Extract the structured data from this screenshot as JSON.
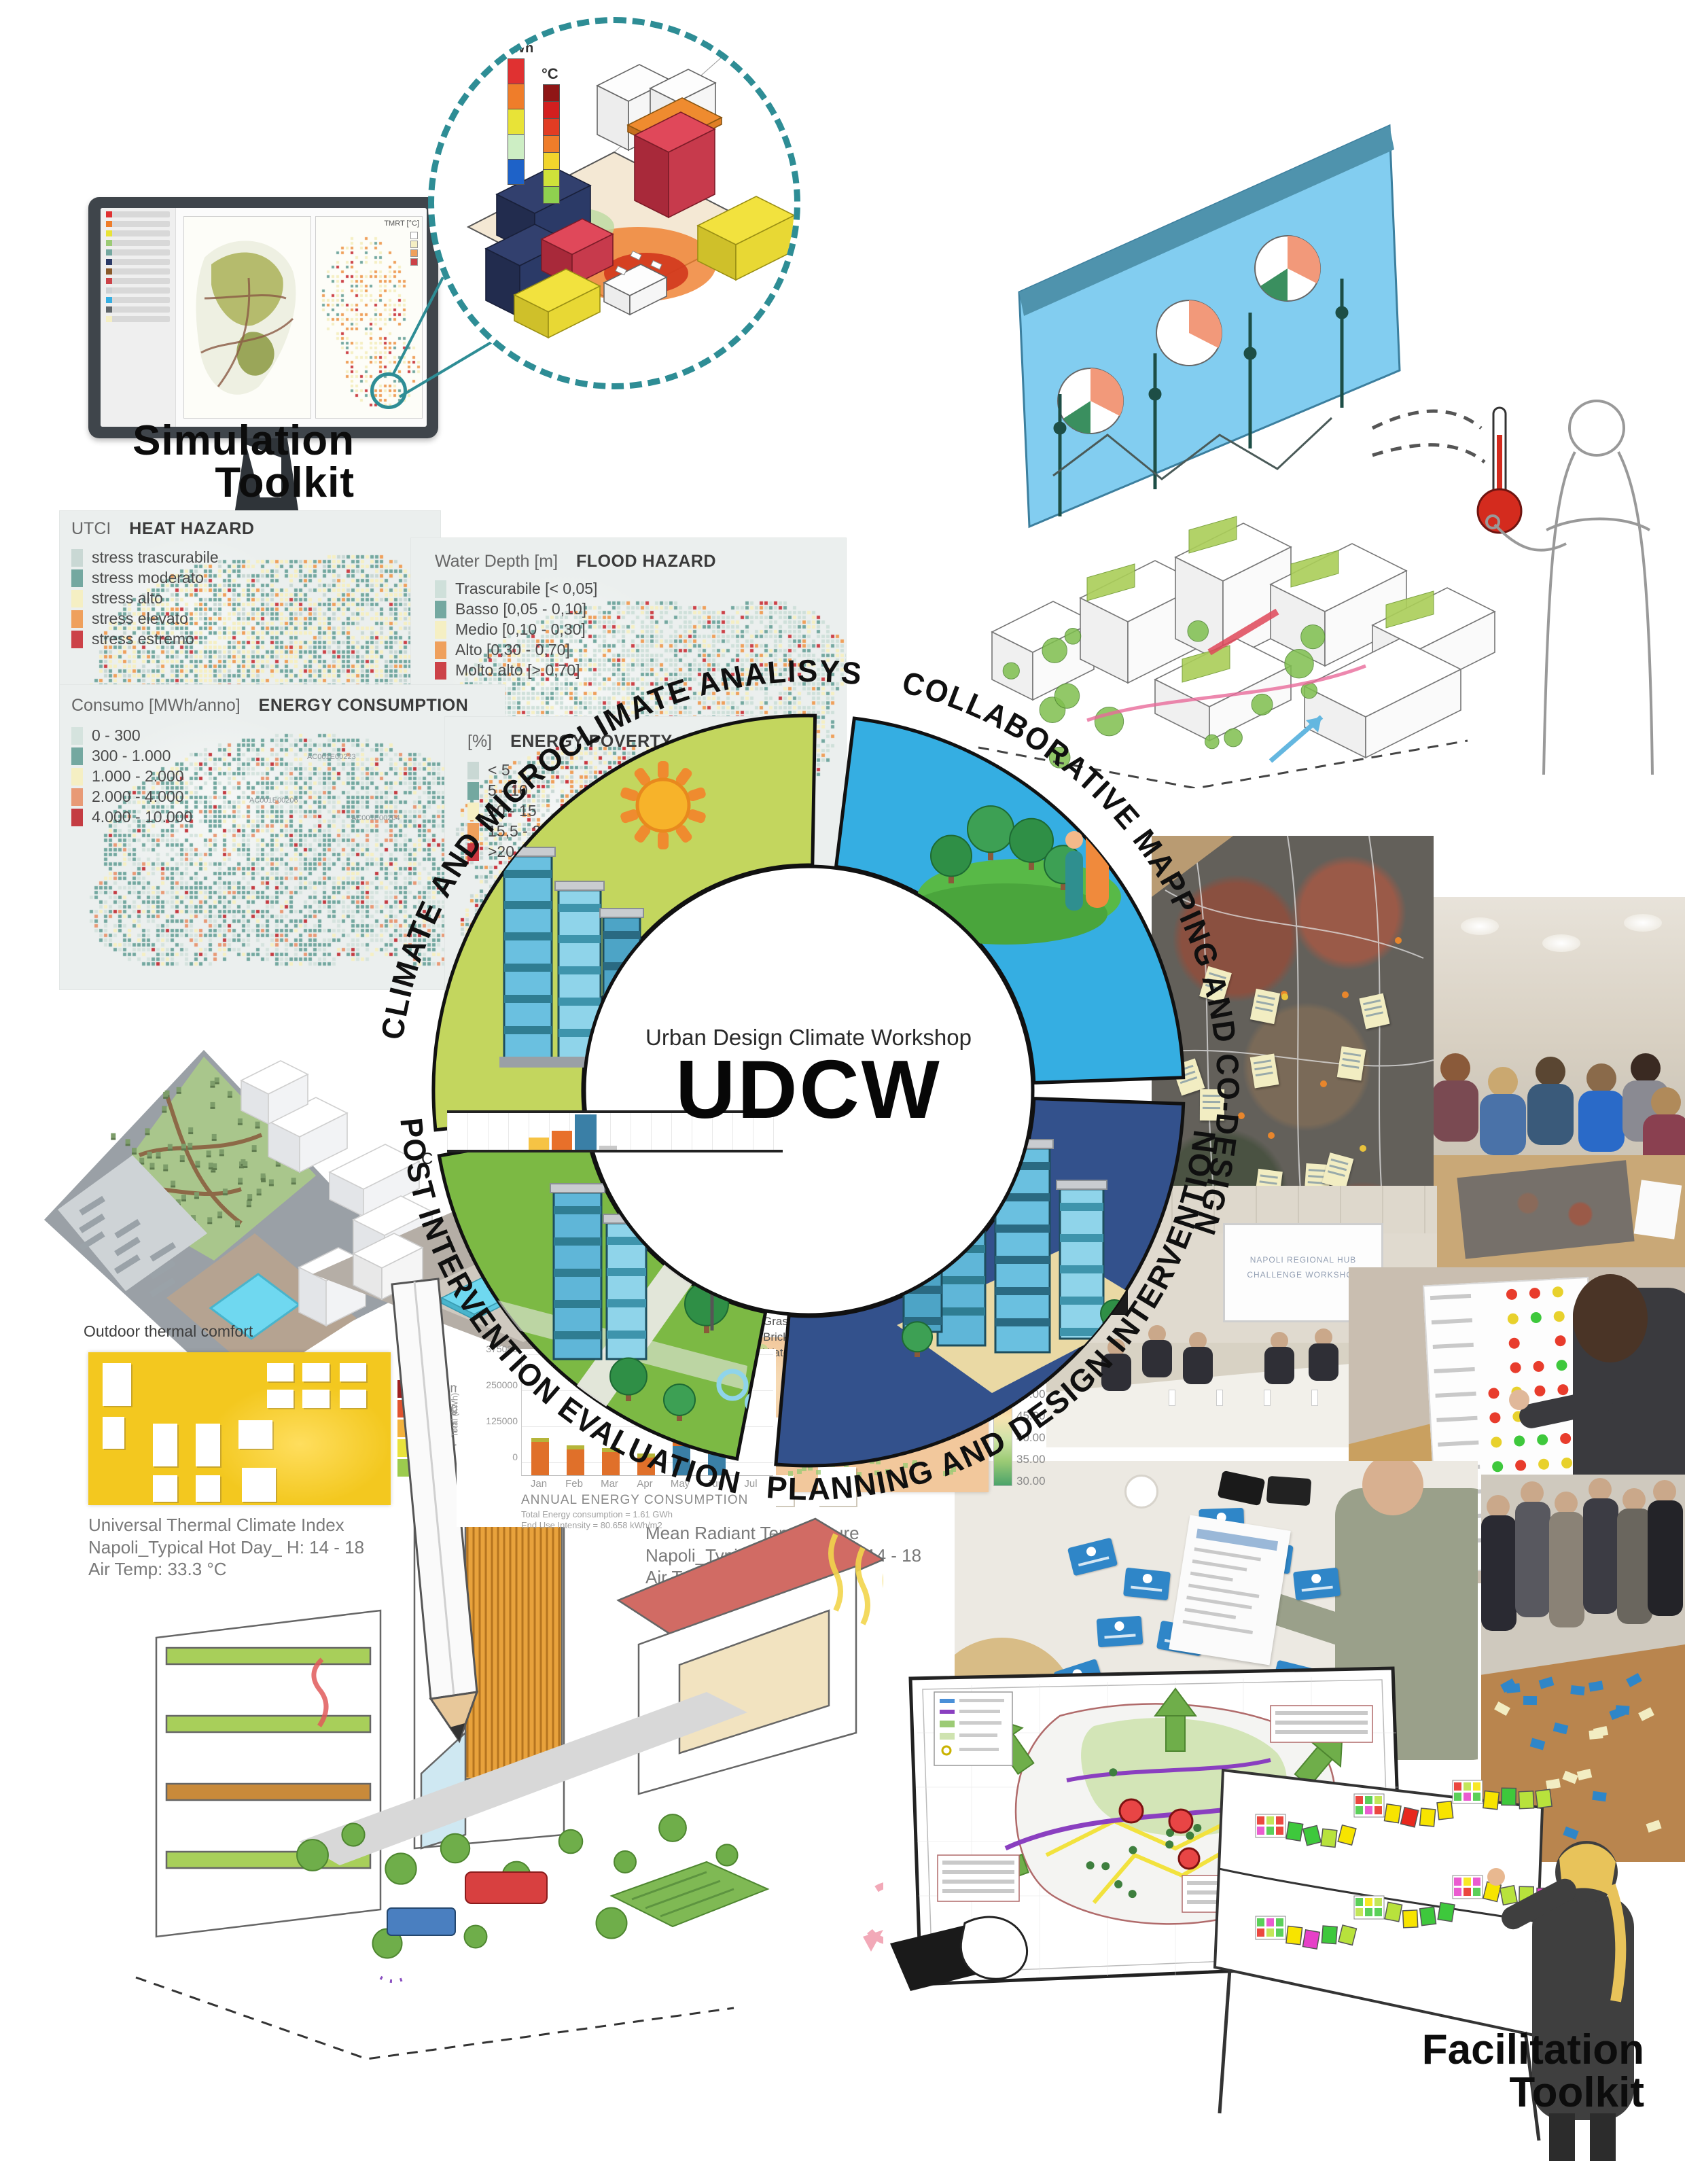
{
  "simulation_toolkit": {
    "label_line1": "Simulation",
    "label_line2": "Toolkit"
  },
  "facilitation_toolkit": {
    "label_line1": "Facilitation",
    "label_line2": "Toolkit"
  },
  "monitor": {
    "map_legend_title": "TMRT [°C]"
  },
  "zoom_detail": {
    "kwh_label": "kWh",
    "celsius_label": "°C",
    "kwh_scale_colors": [
      "#e03131",
      "#ef7d2a",
      "#e8e337",
      "#cdeec4",
      "#1e62c8"
    ],
    "celsius_scale_colors": [
      "#8f1616",
      "#d31f1f",
      "#e23c23",
      "#ef7d2a",
      "#f2d52c",
      "#cfe23a",
      "#8fd14f"
    ],
    "dashed_circle_color": "#2e8d95"
  },
  "maps": {
    "heat_hazard": {
      "prefix": "UTCI",
      "title": "HEAT HAZARD",
      "legend": [
        {
          "label": "stress trascurabile",
          "color": "#c9d8d4"
        },
        {
          "label": "stress moderato",
          "color": "#74a8a0"
        },
        {
          "label": "stress alto",
          "color": "#f5efc3"
        },
        {
          "label": "stress elevato",
          "color": "#efa05c"
        },
        {
          "label": "stress estremo",
          "color": "#cc4248"
        }
      ]
    },
    "flood_hazard": {
      "prefix": "Water Depth [m]",
      "title": "FLOOD HAZARD",
      "legend": [
        {
          "label": "Trascurabile [< 0,05]",
          "color": "#cfe0da"
        },
        {
          "label": "Basso [0,05 - 0,10]",
          "color": "#74a8a0"
        },
        {
          "label": "Medio [0,10 - 0,30]",
          "color": "#f5efc3"
        },
        {
          "label": "Alto [0,30 - 0,70]",
          "color": "#efa05c"
        },
        {
          "label": "Molto alto [> 0,70]",
          "color": "#cc4248"
        }
      ]
    },
    "energy_consumption": {
      "prefix": "Consumo [MWh/anno]",
      "title": "ENERGY CONSUMPTION",
      "legend": [
        {
          "label": "0 - 300",
          "color": "#d5e3de"
        },
        {
          "label": "300 - 1.000",
          "color": "#74a8a0"
        },
        {
          "label": "1.000 - 2.000",
          "color": "#f5efc3"
        },
        {
          "label": "2.000 - 4.000",
          "color": "#e89a76"
        },
        {
          "label": "4.000 - 10.000",
          "color": "#c43c42"
        }
      ],
      "area_codes": [
        "AC001E00223",
        "AC001E00206",
        "AC001E00204"
      ]
    },
    "energy_poverty": {
      "prefix": "[%]",
      "title": "ENERGY POVERTY",
      "legend": [
        {
          "label": "< 5",
          "color": "#c9d8d4"
        },
        {
          "label": "5 - 10",
          "color": "#74a8a0"
        },
        {
          "label": "10 - 15",
          "color": "#f5efc3"
        },
        {
          "label": "15,5 - 20",
          "color": "#efa05c"
        },
        {
          "label": ">20",
          "color": "#c9363f"
        }
      ]
    }
  },
  "ring": {
    "center_line1": "Urban Design Climate Workshop",
    "center_line2": "UDCW",
    "quadrants": [
      {
        "id": "analysis",
        "label": "CLIMATE AND MICROCLIMATE ANALISYS",
        "color": "#c3d65e"
      },
      {
        "id": "codesign",
        "label": "COLLABORATIVE MAPPING AND CO-DESIGN",
        "color": "#35aee2"
      },
      {
        "id": "planning",
        "label": "PLANNING AND DESIGN INTERVENTION",
        "color": "#33518c"
      },
      {
        "id": "evaluation",
        "label": "POST INTERVENTION EVALUATION",
        "color": "#7cb944"
      }
    ]
  },
  "mini_histogram": {
    "partial_axis_label": "C"
  },
  "annual_energy_chart": {
    "title": "ANNUAL ENERGY CONSUMPTION",
    "ylabel": "Total (kWh)",
    "yticks": [
      "375000",
      "250000",
      "125000",
      "0"
    ],
    "months": [
      "Jan",
      "Feb",
      "Mar",
      "Apr",
      "May",
      "Jun",
      "Jul"
    ],
    "note_line1": "Total Energy consumption = 1.61 GWh",
    "note_line2": "End Use Intensity = 80.658 kWh/m2"
  },
  "thermal": {
    "section_label": "Outdoor thermal comfort",
    "utci_caption": {
      "line1": "Universal Thermal Climate Index",
      "line2": "Napoli_Typical Hot Day_ H: 14 - 18",
      "line3": "Air Temp: 33.3 °C"
    },
    "mrt_caption": {
      "line1": "Mean Radiant Temperature",
      "line2": "Napoli_Typical Hot Day_ H: 14 - 18",
      "line3": "Air Temp: 33.3 °C"
    },
    "stress_legend": [
      {
        "label": "Extreme Heat Stress",
        "color": "#9e1f1f"
      },
      {
        "label": "Strong Heat Stress",
        "color": "#e0532f"
      },
      {
        "label": "Heat Stress",
        "color": "#f2b23c"
      },
      {
        "label": "Moderate Heat Stress",
        "color": "#e8e23c"
      },
      {
        "label": "Slight Heat Stress",
        "color": "#9ccb4e"
      }
    ],
    "scale_ticks": [
      "60.00",
      "55.00",
      "50.00",
      "45.00",
      "40.00",
      "35.00",
      "30.00"
    ],
    "landcovers": {
      "title": "Landcovers",
      "items": [
        {
          "label": "Concrete pavement light",
          "color": "#cdd1d4"
        },
        {
          "label": "Asphalt",
          "color": "#5f6569"
        },
        {
          "label": "Grass/meadow",
          "color": "#9ccb75"
        },
        {
          "label": "Brick road_red stones",
          "color": "#8a5a2b"
        },
        {
          "label": "Water",
          "color": "#6fd8f0"
        },
        {
          "label": "Concrete pavement",
          "color": "#9aa0a4"
        },
        {
          "label": "Wood pavement",
          "color": "#a08874"
        }
      ]
    }
  },
  "photos": {
    "projector_line1": "NAPOLI REGIONAL HUB",
    "projector_line2": "CHALLENGE WORKSHOP"
  },
  "chart_data": [
    {
      "type": "bar",
      "title": "ANNUAL ENERGY CONSUMPTION",
      "categories": [
        "Jan",
        "Feb",
        "Mar",
        "Apr",
        "May",
        "Jun",
        "Jul"
      ],
      "series": [
        {
          "name": "monthly energy consumption (kWh, approx)",
          "values": [
            115000,
            88000,
            80000,
            60000,
            100000,
            72000,
            null
          ]
        }
      ],
      "xlabel": "",
      "ylabel": "Total (kWh)",
      "ylim": [
        0,
        500000
      ],
      "bar_colors": [
        "#e0702a",
        "#e0702a",
        "#e0702a",
        "#e0702a",
        "#3a7fa6",
        "#3a7fa6",
        "#3a7fa6"
      ],
      "notes": [
        "Total Energy consumption = 1.61 GWh",
        "End Use Intensity = 80.658 kWh/m2"
      ]
    },
    {
      "type": "bar",
      "title": "unlabeled mini histogram (left of ring)",
      "categories": [
        "",
        "",
        "",
        ""
      ],
      "values": [
        16,
        26,
        46,
        5
      ],
      "bar_colors": [
        "#f6c344",
        "#e8702a",
        "#3a7fa6",
        "#c9c9c9"
      ]
    }
  ]
}
